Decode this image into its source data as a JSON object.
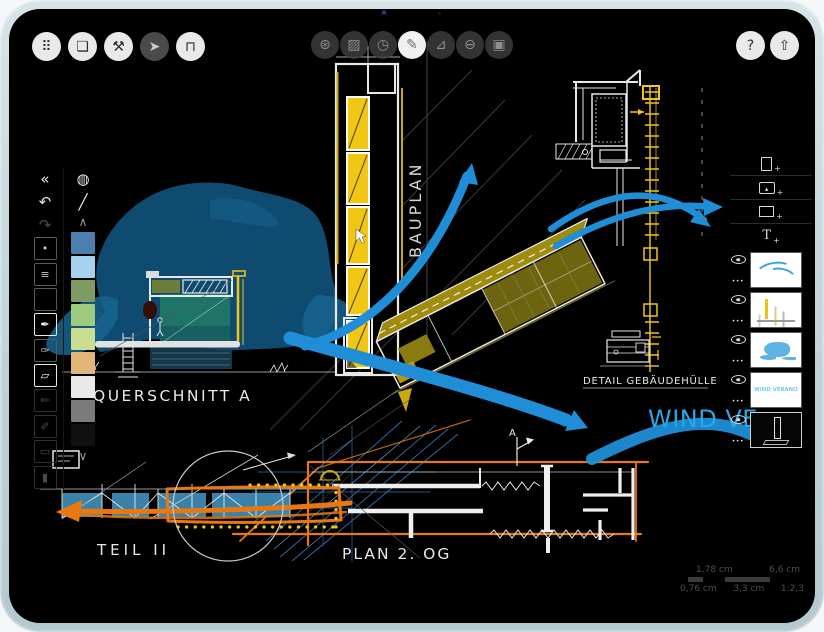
{
  "device": {
    "type": "tablet",
    "camera": "front-camera"
  },
  "top_toolbar": {
    "left_buttons": [
      {
        "name": "canvas-move",
        "glyph": "⠿",
        "active": false
      },
      {
        "name": "pages",
        "glyph": "❏",
        "active": false
      },
      {
        "name": "settings",
        "glyph": "⚒",
        "active": false
      },
      {
        "name": "selection",
        "glyph": "➤",
        "active": true
      },
      {
        "name": "measure",
        "glyph": "⊓",
        "active": false
      }
    ],
    "center_buttons": [
      {
        "name": "brush-wheel",
        "glyph": "⊛",
        "active": false
      },
      {
        "name": "fill",
        "glyph": "▨",
        "active": false
      },
      {
        "name": "compass",
        "glyph": "◷",
        "active": false
      },
      {
        "name": "pen",
        "glyph": "✎",
        "active": true
      },
      {
        "name": "set-square",
        "glyph": "⊿",
        "active": false
      },
      {
        "name": "eraser-ring",
        "glyph": "⊖",
        "active": false
      },
      {
        "name": "mask",
        "glyph": "▣",
        "active": false
      }
    ],
    "right_buttons": [
      {
        "name": "help",
        "glyph": "?"
      },
      {
        "name": "share",
        "glyph": "⇧"
      }
    ]
  },
  "left_panel": {
    "collapse_glyph": "«",
    "undo_glyph": "↶",
    "redo_glyph": "↷",
    "tools": [
      {
        "name": "tool-dot",
        "glyph": "•",
        "state": "normal"
      },
      {
        "name": "tool-slabs",
        "glyph": "≡",
        "state": "normal"
      },
      {
        "name": "tool-frame",
        "glyph": "",
        "state": "normal"
      },
      {
        "name": "tool-fountain-pen",
        "glyph": "✒",
        "state": "selected"
      },
      {
        "name": "tool-airbrush",
        "glyph": "✑",
        "state": "normal"
      },
      {
        "name": "tool-eraser",
        "glyph": "▱",
        "state": "selected"
      },
      {
        "name": "tool-pencil",
        "glyph": "✏",
        "state": "dimmed"
      },
      {
        "name": "tool-brush",
        "glyph": "✐",
        "state": "dimmed"
      },
      {
        "name": "tool-roller",
        "glyph": "▭",
        "state": "dimmed"
      },
      {
        "name": "tool-marker",
        "glyph": "▮",
        "state": "dimmed"
      }
    ],
    "color_wheel_glyph": "◍",
    "eyedropper_glyph": "╱",
    "scroll_up_glyph": "∧",
    "scroll_down_glyph": "∨",
    "swatches": [
      "#4d7fae",
      "#a6d2ee",
      "#7e9b63",
      "#9ecb7e",
      "#cade92",
      "#e2b578",
      "#e9e9e7",
      "#7b7b7b",
      "#111111"
    ]
  },
  "right_panel": {
    "actions": [
      {
        "name": "add-page",
        "plus": "+"
      },
      {
        "name": "insert-image",
        "glyph": "▴",
        "plus": "+"
      },
      {
        "name": "transform",
        "plus": "+"
      },
      {
        "name": "add-text",
        "glyph": "T",
        "plus": "+"
      }
    ],
    "layer_menu_glyph": "•••",
    "layers": [
      {
        "name": "layer-arrows",
        "thumb": "arrows",
        "visible": true,
        "selected": false
      },
      {
        "name": "layer-drawings",
        "thumb": "plans",
        "visible": true,
        "selected": false
      },
      {
        "name": "layer-blob",
        "thumb": "blob",
        "visible": true,
        "selected": false
      },
      {
        "name": "layer-wind-text",
        "thumb": "text",
        "thumb_label": "WIND VERANO",
        "visible": true,
        "selected": false
      },
      {
        "name": "layer-active-sketch",
        "thumb": "dark",
        "visible": true,
        "selected": true
      }
    ]
  },
  "status_bar": {
    "width_value": "1,78 cm",
    "length_value": "6,6 cm",
    "small_scale_value": "0,76 cm",
    "mid_scale_value": "3,3 cm",
    "ratio_value": "1:2,3"
  },
  "canvas": {
    "labels": {
      "querschnitt": "QUERSCHNITT A",
      "bauplan": "BAUPLAN",
      "detail": "DETAIL GEBÄUDEHÜLLE",
      "wind": "WIND VE",
      "teil": "TEIL II",
      "plan": "PLAN 2. OG",
      "section_marker": "A"
    },
    "colors": {
      "arrow_blue": "#1f8ed6",
      "blob_dark": "#0f4a70",
      "blob_mid": "#176591",
      "teal_fill": "#1f7468",
      "teal_dark": "#175f60",
      "underground": "#1a4a63",
      "yellow": "#f2c713",
      "yellow_dim": "#c9a90e",
      "olive_top": "#a08c0c",
      "olive_dark": "#6e6410",
      "olive_green": "#6f7d3a",
      "orange": "#e8780f",
      "steel_blue": "#3b82aa",
      "sketch_white": "#e8e8e8",
      "construction_blue": "#2f6fae",
      "wind_text": "#28a7e6",
      "hatch_gray": "#3a3a3a"
    }
  }
}
